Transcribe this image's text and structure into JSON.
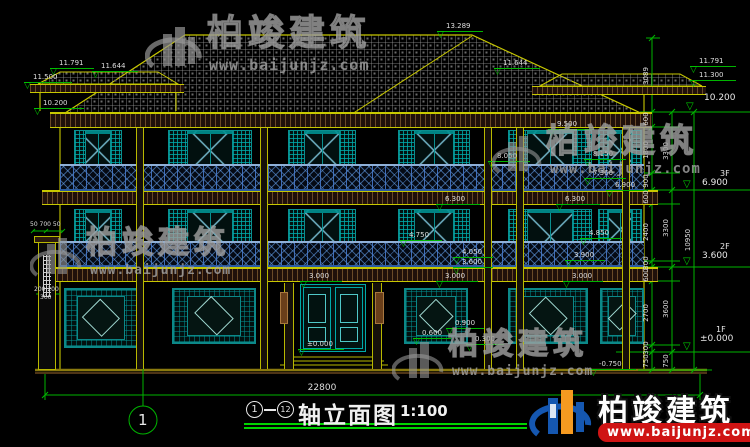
{
  "watermark": {
    "company": "柏竣建筑",
    "website": "www.baijunjz.com"
  },
  "markers": {
    "m13289": "13.289",
    "m11791L": "11.791",
    "m11644L": "11.644",
    "m11500L": "11.500",
    "m10200L": "10.200",
    "m11644R": "11.644",
    "m11791R": "11.791",
    "m11300R": "11.300",
    "m9500": "9.500",
    "m8050": "8.050",
    "m8150": "8.150",
    "m7360": "7.360",
    "m6900": "6.900",
    "m6300a": "6.300",
    "m6300b": "6.300",
    "m4750": "4.750",
    "m4850": "4.850",
    "m4050": "4.050",
    "m3600": "3.600",
    "m3900": "3.900",
    "m3000a": "3.000",
    "m3000b": "3.000",
    "m3000c": "3.000",
    "m0900": "0.900",
    "m0600": "0.600",
    "m0300": "0.300",
    "m0000": "±0.000",
    "mneg0750": "-0.750"
  },
  "levels_right": {
    "top": "10.200",
    "f3_label": "3F",
    "f3_value": "6.900",
    "f2_label": "2F",
    "f2_value": "3.600",
    "f1_label": "1F",
    "f1_value": "±0.000"
  },
  "chains": {
    "inner": [
      "3089",
      "600",
      "1800",
      "900",
      "600",
      "2400",
      "300",
      "600",
      "2700",
      "300",
      "750"
    ],
    "middle": [
      "3300",
      "3300",
      "3600",
      "750"
    ],
    "outer": [
      "10950"
    ]
  },
  "left_dims": {
    "d1": "50 700 50",
    "d2": "200 200",
    "d3": "300"
  },
  "bottom": {
    "overall_dim": "22800",
    "axis_bubble": "1",
    "title_axis_start": "1",
    "title_axis_end": "12",
    "title_text": "轴立面图",
    "title_scale": "1:100"
  }
}
